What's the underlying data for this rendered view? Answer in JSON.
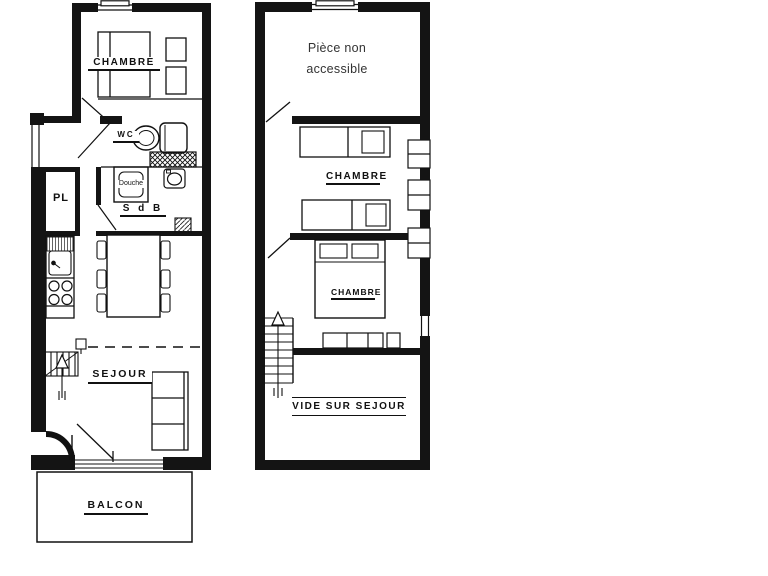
{
  "document": {
    "type": "apartment floor plan, two levels",
    "background_color": "#ffffff",
    "ink_color": "#141414"
  },
  "ground_floor": {
    "labels": {
      "chambre": "CHAMBRE",
      "wc": "WC",
      "douche": "Douche",
      "salle_de_bain": "S d B",
      "placard": "PL",
      "sejour": "SEJOUR",
      "balcon": "BALCON"
    },
    "fixtures": [
      "double-bed",
      "nightstands",
      "toilet",
      "vent-crosshatch",
      "shower-tray",
      "washbasin",
      "closet",
      "kitchen-sink",
      "stove-four-burners",
      "dining-table-six-chairs",
      "staircase-up-arrow",
      "sofa-three-seats",
      "entrance-door-swing",
      "balcony-door-swing",
      "window-top",
      "window-left"
    ]
  },
  "upper_floor": {
    "labels": {
      "piece_non_accessible": "Pièce non accessible",
      "chambre_top": "CHAMBRE",
      "chambre_bottom": "CHAMBRE",
      "vide_sur_sejour": "VIDE SUR SEJOUR"
    },
    "fixtures": [
      "single-bed-with-pillow",
      "nightstand",
      "single-bed-2",
      "double-bed-two-pillows",
      "low-cabinet",
      "staircase-down-arrow",
      "door-swings",
      "window-top",
      "right-wall-windows-x3",
      "right-wall-window-gap"
    ]
  }
}
